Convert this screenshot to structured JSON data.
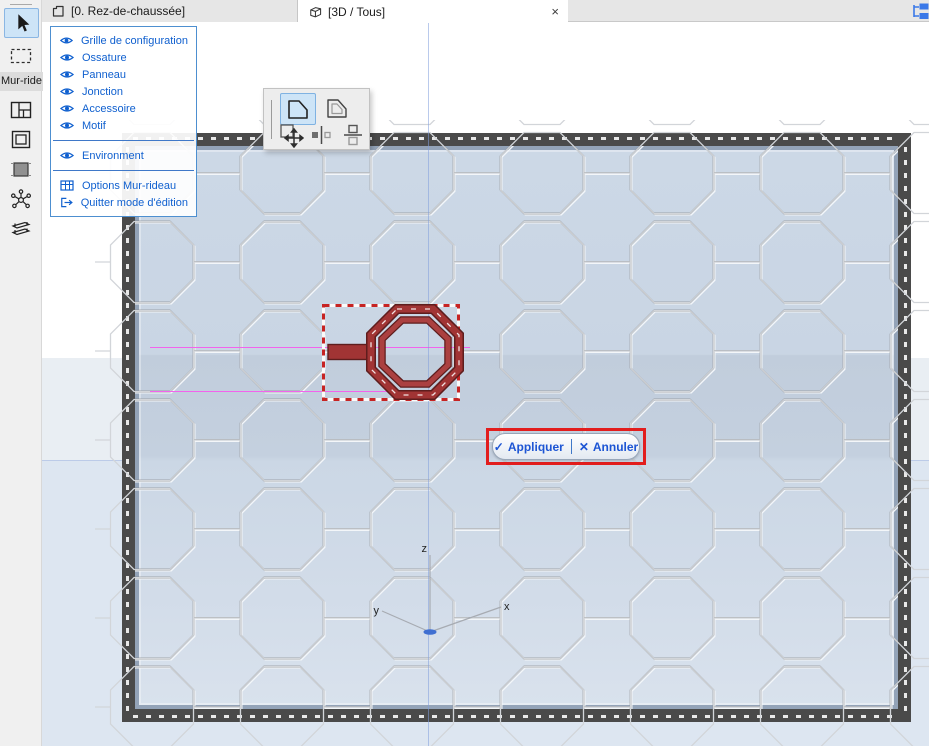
{
  "window": {
    "tabs": [
      {
        "label": "[0. Rez-de-chaussée]"
      },
      {
        "label": "[3D / Tous]",
        "close_glyph": "×"
      }
    ]
  },
  "toolbox": {
    "group_label": "Mur-ride"
  },
  "edit_panel": {
    "items": [
      {
        "label": "Grille de configuration"
      },
      {
        "label": "Ossature"
      },
      {
        "label": "Panneau"
      },
      {
        "label": "Jonction"
      },
      {
        "label": "Accessoire"
      },
      {
        "label": "Motif"
      },
      {
        "label": "Environment"
      },
      {
        "label": "Options Mur-rideau"
      },
      {
        "label": "Quitter mode d'édition"
      }
    ]
  },
  "actions": {
    "apply_glyph": "✓",
    "apply_label": "Appliquer",
    "cancel_glyph": "✕",
    "cancel_label": "Annuler"
  },
  "axes": {
    "x_label": "x",
    "y_label": "y",
    "z_label": "z"
  },
  "colors": {
    "accent_blue": "#1060cf",
    "selection_red": "#e21d1d",
    "object_red": "#a13434",
    "magenta_guide": "#f263ec",
    "wall_blue": "#c9d5e4",
    "frame_dark": "#4a4a4a"
  }
}
